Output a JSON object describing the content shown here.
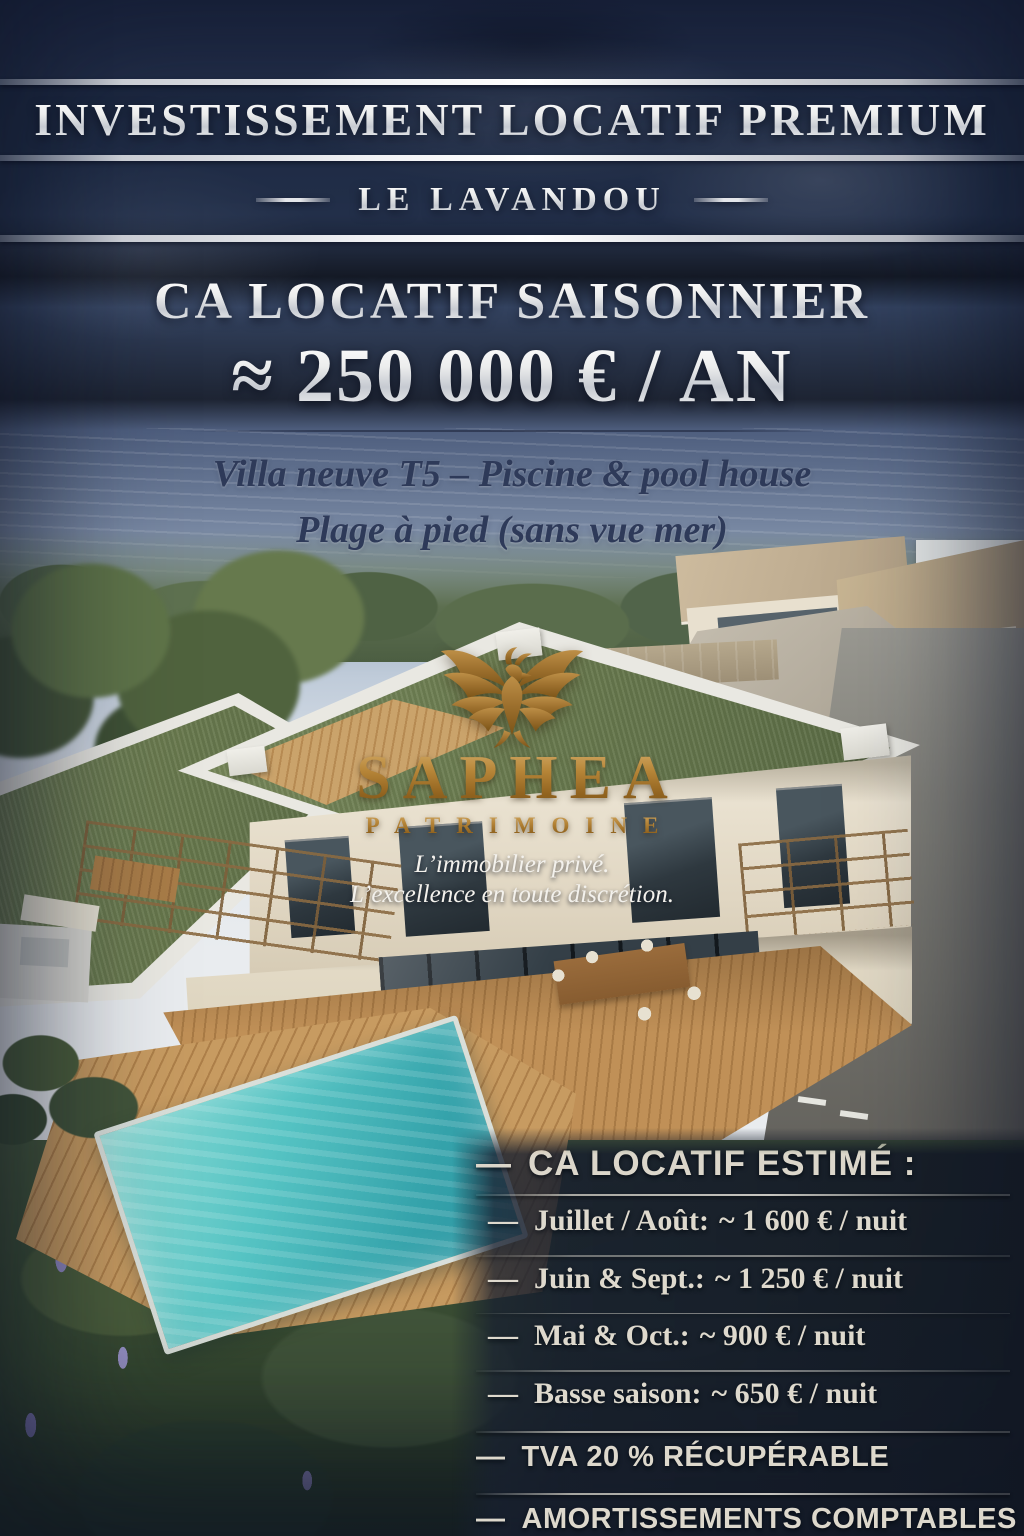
{
  "header": {
    "title": "INVESTISSEMENT LOCATIF PREMIUM",
    "location": "LE LAVANDOU"
  },
  "revenue": {
    "line1": "CA LOCATIF SAISONNIER",
    "line2": "≈ 250 000 € / AN"
  },
  "property": {
    "line1": "Villa neuve T5 – Piscine & pool house",
    "line2": "Plage à pied (sans vue mer)"
  },
  "brand": {
    "name": "SAPHEA",
    "subtitle": "PATRIMOINE",
    "tagline1": "L’immobilier privé.",
    "tagline2": "L’excellence en toute discrétion.",
    "icon": "phoenix-icon"
  },
  "estimates": {
    "dash": "—",
    "heading": "CA LOCATIF ESTIMÉ :",
    "items": [
      {
        "label": "Juillet / Août:",
        "value": "~ 1 600 € / nuit"
      },
      {
        "label": "Juin & Sept.:",
        "value": "~ 1 250 € / nuit"
      },
      {
        "label": "Mai & Oct.:",
        "value": "~ 900 € / nuit"
      },
      {
        "label": "Basse saison:",
        "value": "~ 650 € / nuit"
      }
    ],
    "extras": [
      "TVA 20 % RÉCUPÉRABLE",
      "AMORTISSEMENTS COMPTABLES"
    ]
  },
  "colors": {
    "sky_navy": "#2c3a57",
    "silver_text": "#e8e6e1",
    "gold": "#a5732c",
    "panel_bg": "#1c2434",
    "pool_turquoise": "#3fb3b5",
    "roof_green": "#6d7f52",
    "deck_wood": "#b98a52",
    "dark_heading": "#2e3a59"
  }
}
